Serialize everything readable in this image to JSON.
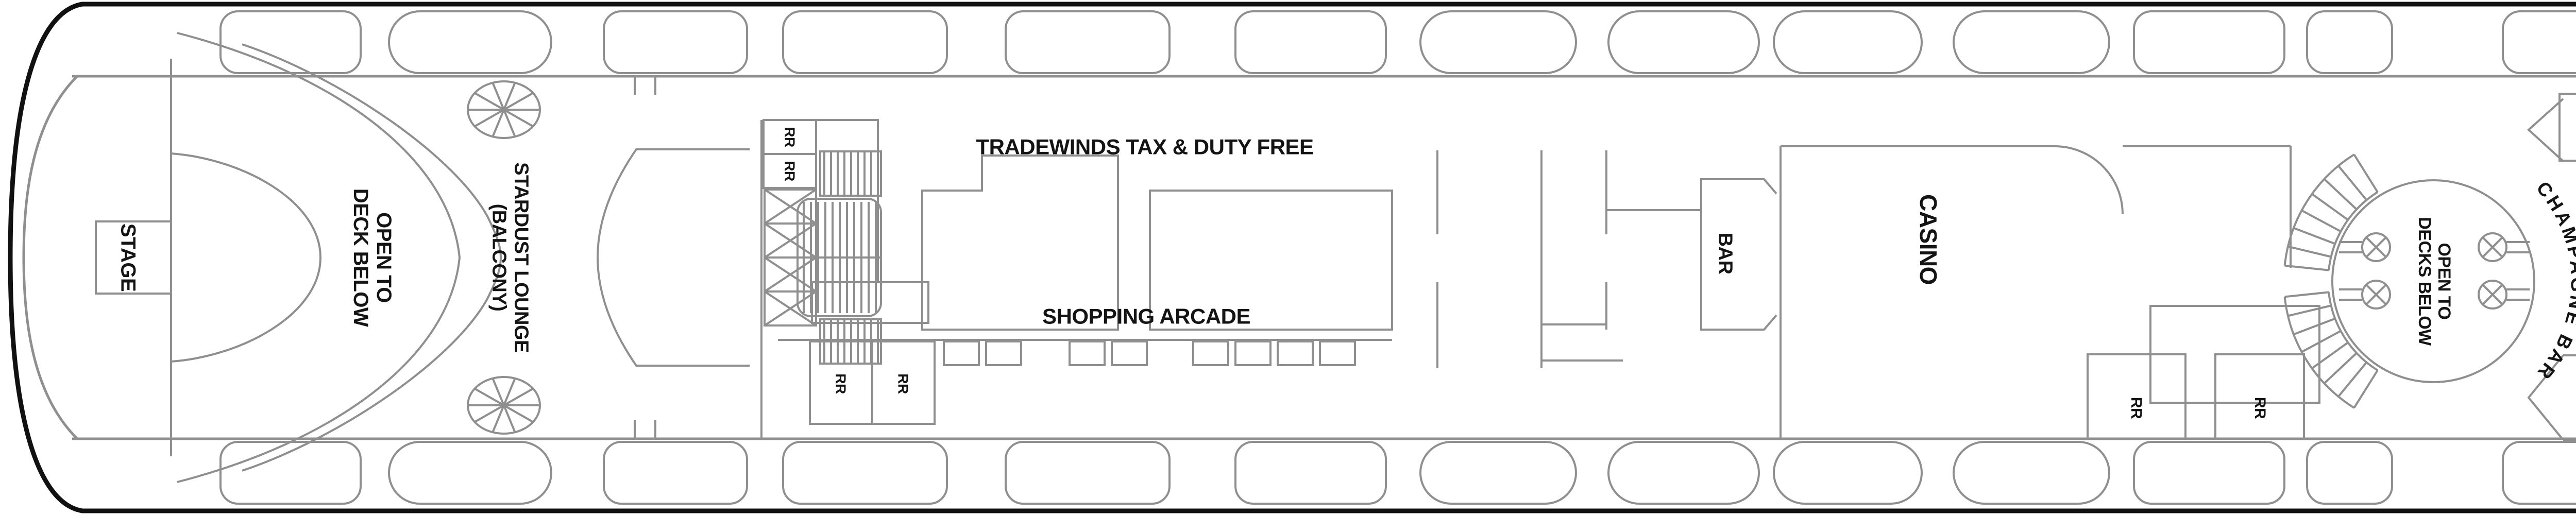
{
  "labels": {
    "stage_aft": "STAGE",
    "open_to_deck_below": "OPEN TO\nDECK BELOW",
    "stardust": "STARDUST LOUNGE\n(BALCONY)",
    "rr": "RR",
    "tradewinds": "TRADEWINDS TAX & DUTY FREE",
    "shopping_arcade": "SHOPPING ARCADE",
    "bar": "BAR",
    "casino": "CASINO",
    "open_to_decks_below": "OPEN TO\nDECKS BELOW",
    "champagne_bar": "CHAMPAGNE BAR",
    "ramp": "RAMP",
    "art_gallery": "ART GALLERY",
    "entourage": "ENTOURAGE\nTEEN CLUB",
    "splash_academy": "SPLASH ACADEMY\nYOUTH CENTER",
    "stage_forward": "STAGE"
  },
  "badges": {
    "cabin_7109": "7109+",
    "cabin_7310": "7310+",
    "cabin_7309": "7309+"
  },
  "icons": {
    "connecting_arrow_glyph": "↔",
    "bed_arrow": "solid-triangle",
    "elevator": "circle-x-elevator",
    "crew_area": "x-box",
    "stairs": "hatched-stairs",
    "spiral_stairs": "spiral-stairs",
    "lifeboat": "lifeboat-outline"
  },
  "colors": {
    "outside_cabin": "#a04040",
    "inside_cabin": "#e9e9e9",
    "badge_bg": "#3c3c3c",
    "wall": "#8f8f8f",
    "hull": "#111111",
    "text": "#141414",
    "outside_cabin_text": "#ffffff"
  },
  "cabin_rows": [
    {
      "id": "row-7000",
      "series": "70xx outside (top)",
      "cabins": [
        {
          "n": "7014",
          "tri": false,
          "dbl": false
        },
        {
          "n": "7013",
          "tri": true,
          "dbl": false
        },
        {
          "n": "7012",
          "tri": true,
          "dbl": false
        },
        {
          "n": "7011",
          "tri": true,
          "dbl": false
        },
        {
          "n": "7010",
          "tri": true,
          "dbl": false
        },
        {
          "n": "7009",
          "tri": true,
          "dbl": false
        },
        {
          "n": "7008",
          "tri": true,
          "dbl": false
        },
        {
          "n": "7007",
          "tri": true,
          "dbl": false
        },
        {
          "n": "7006",
          "tri": true,
          "dbl": false
        },
        {
          "n": "7005",
          "tri": true,
          "dbl": false
        },
        {
          "n": "7004",
          "tri": true,
          "dbl": true
        },
        {
          "n": "7003",
          "tri": true,
          "dbl": false
        },
        {
          "n": "7002",
          "tri": true,
          "dbl": true
        },
        {
          "n": "7001",
          "tri": true,
          "dbl": false
        }
      ]
    },
    {
      "id": "row-7100",
      "series": "71xx inside (upper)",
      "cabins": [
        {
          "n": "7112",
          "tri": true,
          "dbl": false
        },
        {
          "n": "7111",
          "tri": true,
          "dbl": false
        },
        {
          "n": "7110",
          "tri": true,
          "dbl": false
        },
        {
          "n": "7108",
          "tri": true,
          "dbl": false
        },
        {
          "n": "7107",
          "tri": true,
          "dbl": true
        },
        {
          "n": "7106",
          "tri": true,
          "dbl": false
        },
        {
          "n": "7105",
          "tri": true,
          "dbl": false
        },
        {
          "n": "7104",
          "tri": true,
          "dbl": false
        },
        {
          "n": "7103",
          "tri": true,
          "dbl": false
        },
        {
          "n": "7102",
          "tri": true,
          "dbl": false
        },
        {
          "n": "7101",
          "tri": true,
          "dbl": false
        }
      ]
    },
    {
      "id": "row-7300",
      "series": "73xx inside (lower)",
      "cabins": [
        {
          "n": "7315",
          "tri": true,
          "dbl": false
        },
        {
          "n": "7314",
          "tri": true,
          "dbl": false
        },
        {
          "n": "7313",
          "tri": true,
          "dbl": false
        },
        {
          "n": "7312",
          "tri": true,
          "dbl": false
        },
        {
          "n": "7311",
          "tri": true,
          "dbl": false
        },
        {
          "n": "7308",
          "tri": true,
          "dbl": false
        },
        {
          "n": "7307",
          "tri": true,
          "dbl": true
        },
        {
          "n": "7306",
          "tri": true,
          "dbl": false
        },
        {
          "n": "7305",
          "tri": true,
          "dbl": false
        },
        {
          "n": "7304",
          "tri": true,
          "dbl": false
        },
        {
          "n": "7303",
          "tri": true,
          "dbl": false
        },
        {
          "n": "7302",
          "tri": true,
          "dbl": false
        },
        {
          "n": "7301",
          "tri": true,
          "dbl": false
        }
      ]
    },
    {
      "id": "row-7200",
      "series": "72xx outside (bottom)",
      "cabins": [
        {
          "n": "7214",
          "tri": false,
          "dbl": false
        },
        {
          "n": "7213",
          "tri": true,
          "dbl": false
        },
        {
          "n": "7212",
          "tri": true,
          "dbl": false
        },
        {
          "n": "7211",
          "tri": true,
          "dbl": false
        },
        {
          "n": "7210",
          "tri": true,
          "dbl": false
        },
        {
          "n": "7209",
          "tri": true,
          "dbl": false
        },
        {
          "n": "7208",
          "tri": true,
          "dbl": false
        },
        {
          "n": "7207",
          "tri": true,
          "dbl": false
        },
        {
          "n": "7206",
          "tri": true,
          "dbl": false
        },
        {
          "n": "7205",
          "tri": true,
          "dbl": false
        },
        {
          "n": "7204",
          "tri": true,
          "dbl": true
        },
        {
          "n": "7203",
          "tri": true,
          "dbl": false
        },
        {
          "n": "7202",
          "tri": true,
          "dbl": true
        },
        {
          "n": "7201",
          "tri": true,
          "dbl": false
        }
      ]
    }
  ]
}
